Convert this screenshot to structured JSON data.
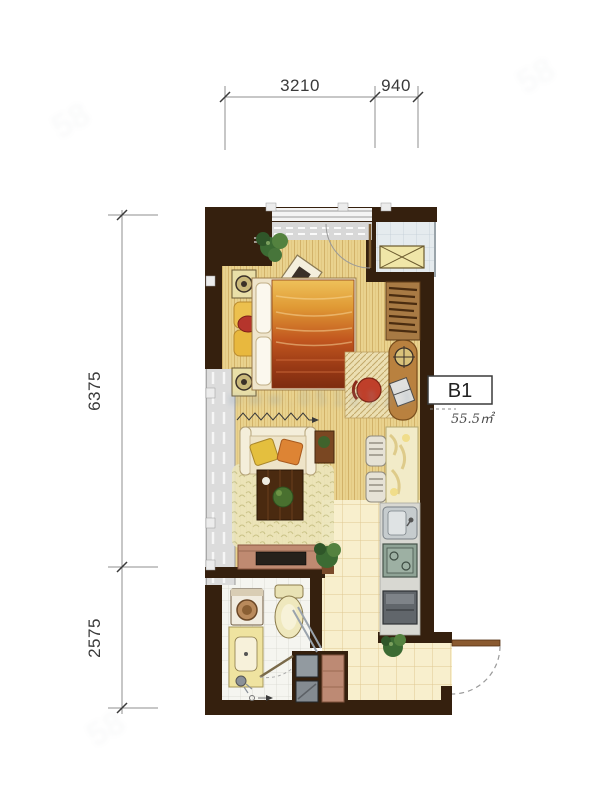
{
  "plan": {
    "unit": {
      "code": "B1",
      "area": "55.5㎡"
    },
    "dimensions": {
      "top_main": "3210",
      "top_right": "940",
      "left_upper": "6375",
      "left_lower": "2575"
    },
    "watermark": {
      "center": "www.0512123",
      "corner": "58"
    },
    "colors": {
      "wall": "#35200e",
      "wood_floor": "#e9d28e",
      "tile_floor": "#f8efcd",
      "bath_tile": "#f5f5f0",
      "platform_tile": "#e5ebee",
      "balcony_gray": "#dcdcdc",
      "bed_orange": "#c2571f",
      "accent_red": "#b5352c",
      "cabinet_rose": "#bf8a71",
      "stove_green": "#8fa396"
    },
    "furniture_icons": [
      "bed",
      "pillows",
      "bedside-cushions",
      "wall-speaker-frames",
      "plant",
      "tilted-picture",
      "sofa",
      "sofa-cushions",
      "coffee-table",
      "area-rug",
      "side-table",
      "tv-cabinet",
      "tv",
      "desk",
      "laptop",
      "desk-chair",
      "ceiling-lamp-symbol",
      "wardrobe-hangers",
      "dining-table",
      "dining-chairs",
      "kitchen-counter",
      "kitchen-sink",
      "gas-stove",
      "appliance",
      "refactory-block",
      "toilet",
      "washing-machine",
      "vanity-sink",
      "shower-screen",
      "shower-head",
      "floor-drain",
      "air-conditioner-unit",
      "entry-door",
      "interior-doors",
      "window-band",
      "balcony-strip"
    ]
  }
}
